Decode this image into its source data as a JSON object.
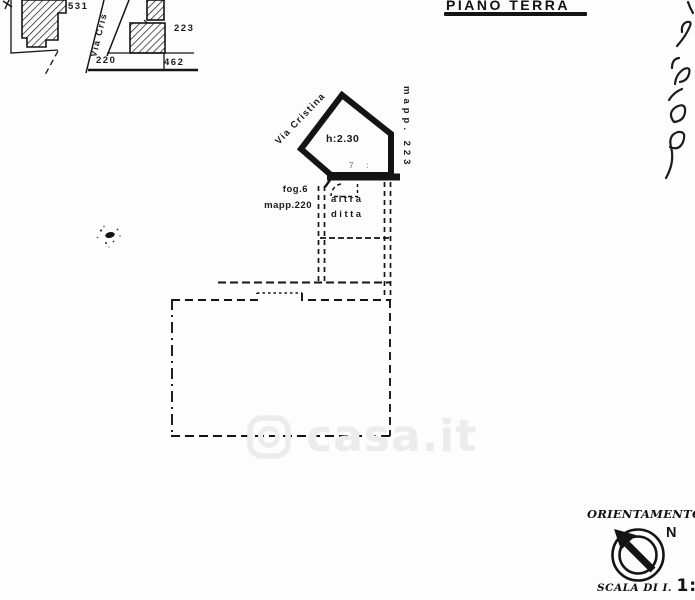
{
  "colors": {
    "ink": "#141414",
    "pencil": "#9b9b9b",
    "watermark": "#ececec"
  },
  "title": "PIANO TERRA",
  "inset_map": {
    "street_label": "Via Cris",
    "parcels": [
      "531",
      "223",
      "220",
      "462"
    ]
  },
  "plan": {
    "street_label": "Via Cristina",
    "parcel_right_label": "mapp. 223",
    "room_height_label": "h:2.30",
    "sheet_label": "fog.6",
    "parcel_label": "mapp.220",
    "neighbor_line1": "altra",
    "neighbor_line2": "ditta",
    "pencil_mark_1": "7",
    "pencil_mark_2": ":"
  },
  "watermark_text": "casa.it",
  "orientation": {
    "label": "ORIENTAMENTO",
    "north_label": "N"
  },
  "scale": {
    "prefix": "SCALA DI I.",
    "value": "1:20"
  }
}
